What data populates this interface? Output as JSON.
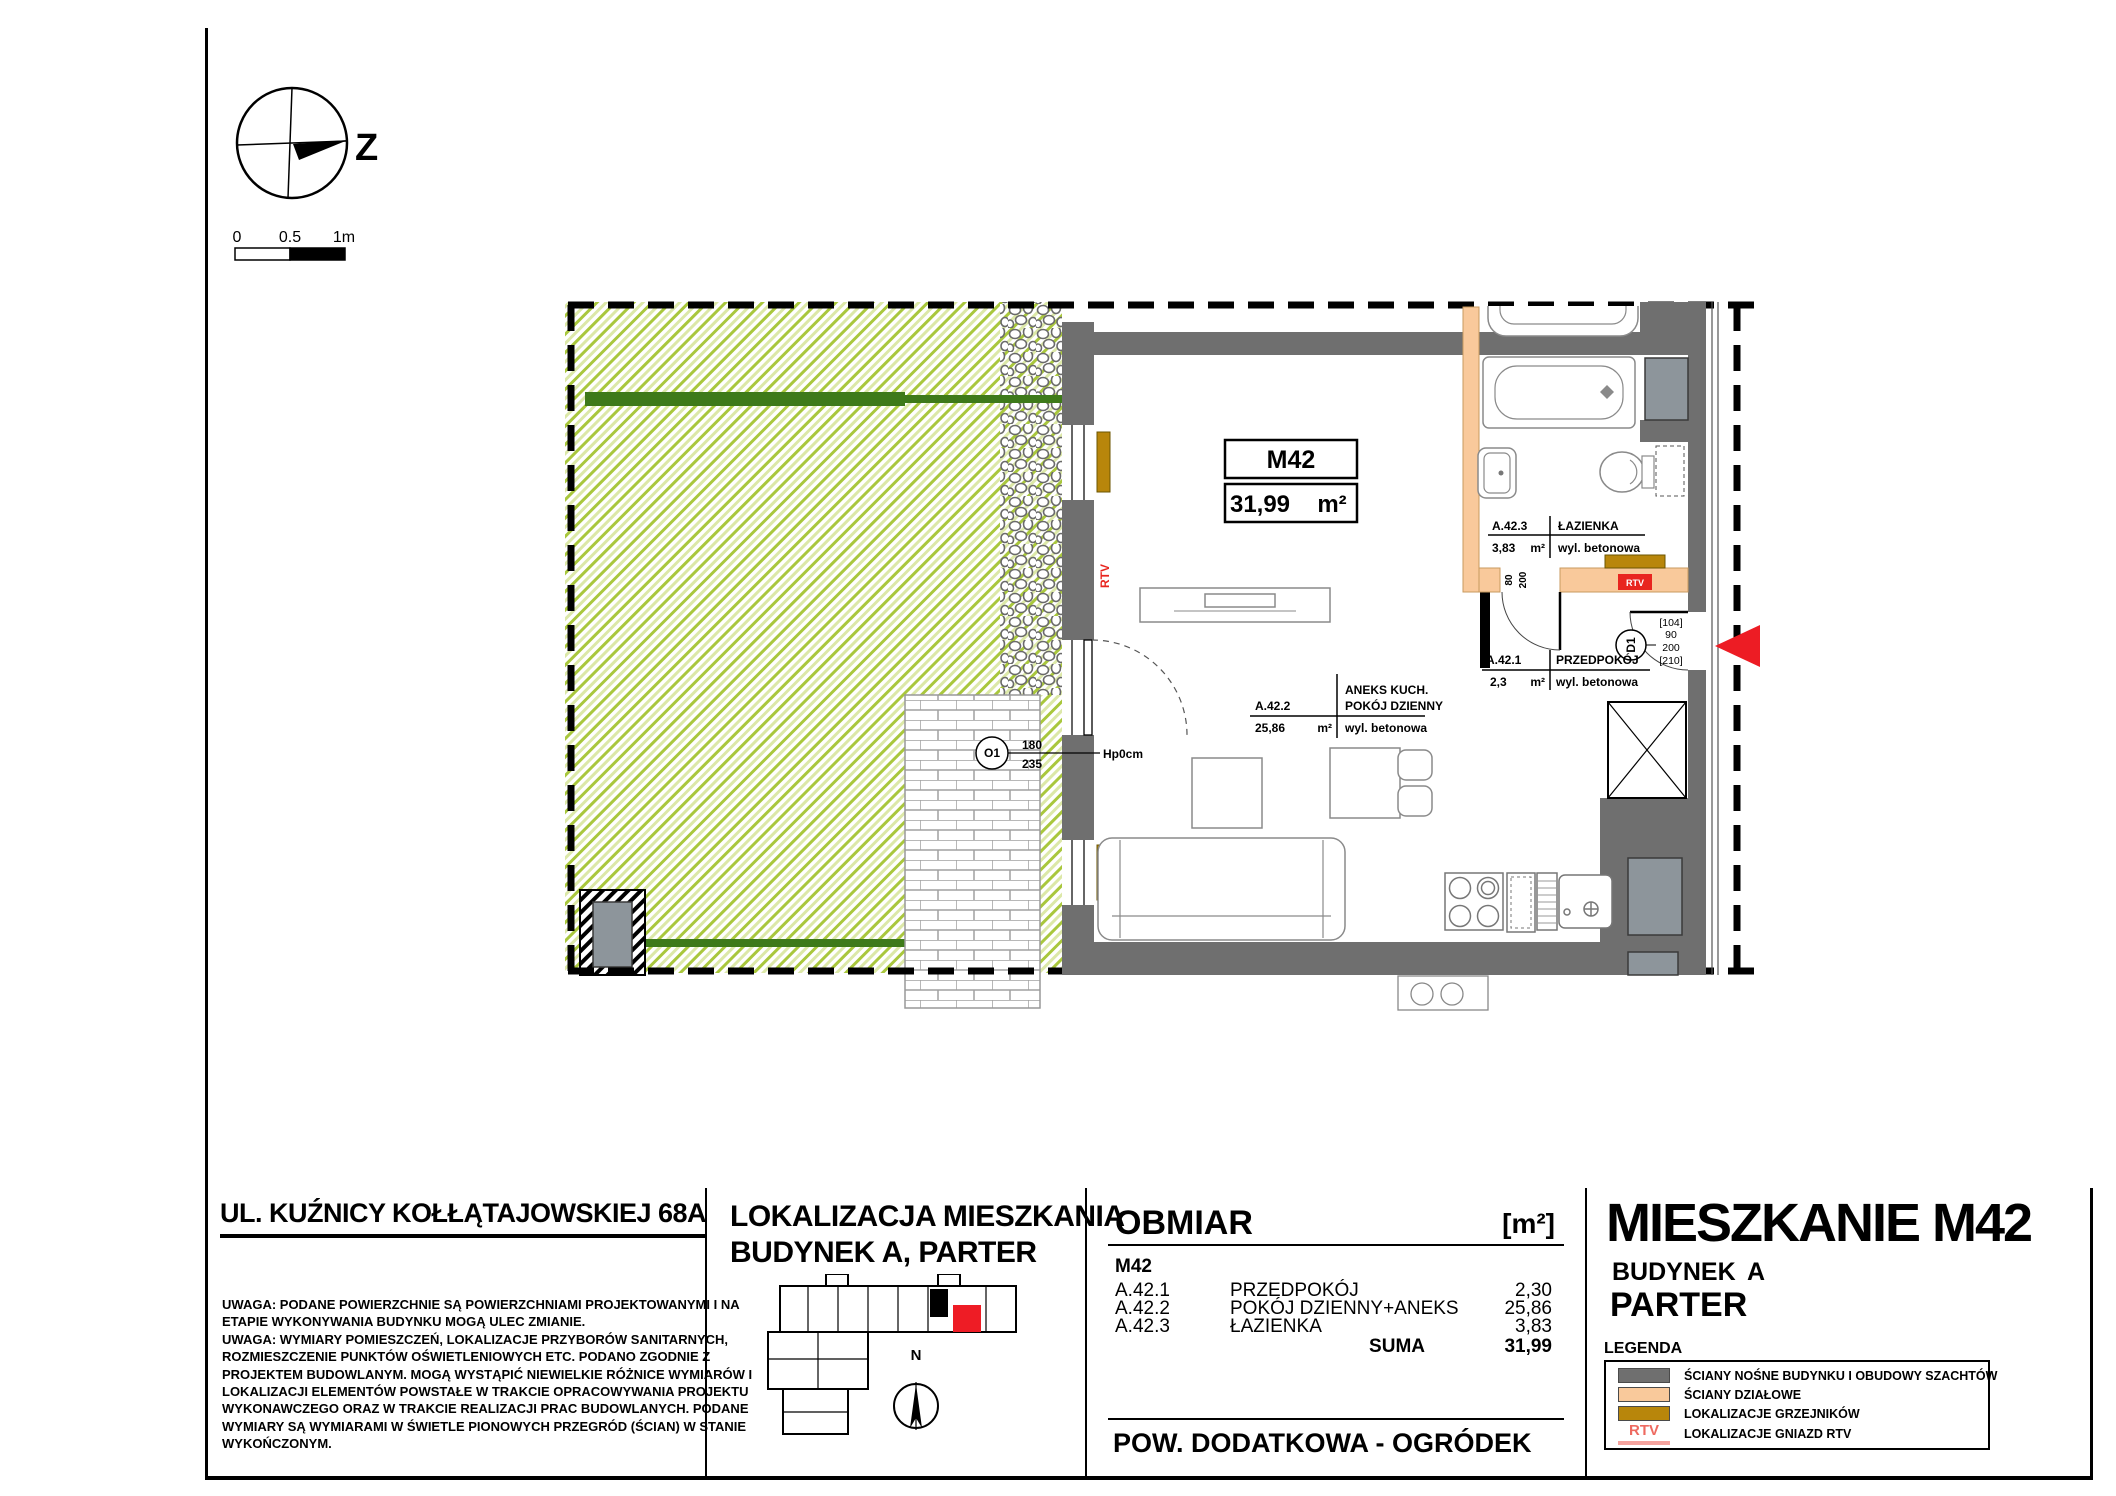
{
  "compass_main": {
    "label": "Z"
  },
  "compass_mini": {
    "label": "N"
  },
  "scale_bar": {
    "zero": "0",
    "half": "0.5",
    "one": "1m"
  },
  "plan": {
    "unit_code": "M42",
    "unit_area": "31,99",
    "unit_area_unit": "m²",
    "room_bath": {
      "code": "A.42.3",
      "name": "ŁAZIENKA",
      "area": "3,83",
      "unit": "m²",
      "finish": "wyl. betonowa"
    },
    "room_hall": {
      "code": "A.42.1",
      "name": "PRZEDPOKÓJ",
      "area": "2,3",
      "unit": "m²",
      "finish": "wyl. betonowa"
    },
    "room_living": {
      "code": "A.42.2",
      "name1": "ANEKS KUCH.",
      "name2": "POKÓJ DZIENNY",
      "area": "25,86",
      "unit": "m²",
      "finish": "wyl. betonowa"
    },
    "door_o1": {
      "code": "O1",
      "width": "180",
      "height": "235",
      "sill": "Hp0cm"
    },
    "door_d1": {
      "code": "D1",
      "dim1": "[104]",
      "dim2": "90",
      "dim3": "200",
      "dim4": "[210]"
    },
    "door_bath": {
      "width": "80",
      "height": "200"
    },
    "rtv_label": "RTV"
  },
  "address": {
    "title": "UL. KUŹNICY KOŁŁĄTAJOWSKIEJ 68A",
    "notes": [
      "UWAGA: PODANE POWIERZCHNIE SĄ POWIERZCHNIAMI PROJEKTOWANYMI I NA",
      "ETAPIE WYKONYWANIA BUDYNKU MOGĄ ULEC ZMIANIE.",
      "UWAGA: WYMIARY POMIESZCZEŃ, LOKALIZACJE PRZYBORÓW SANITARNYCH,",
      "ROZMIESZCZENIE PUNKTÓW OŚWIETLENIOWYCH ETC. PODANO ZGODNIE Z",
      "PROJEKTEM BUDOWLANYM. MOGĄ WYSTĄPIĆ NIEWIELKIE RÓŻNICE WYMIARÓW I",
      "LOKALIZACJI ELEMENTÓW POWSTAŁE W TRAKCIE OPRACOWYWANIA PROJEKTU",
      "WYKONAWCZEGO ORAZ W TRAKCIE REALIZACJI PRAC BUDOWLANYCH. PODANE",
      "WYMIARY SĄ WYMIARAMI W ŚWIETLE PIONOWYCH PRZEGRÓD (ŚCIAN) W STANIE",
      "WYKOŃCZONYM."
    ]
  },
  "location": {
    "line1": "LOKALIZACJA MIESZKANIA",
    "line2": "BUDYNEK A, PARTER"
  },
  "obmiar": {
    "title": "OBMIAR",
    "unit": "[m²]",
    "group": "M42",
    "rows": [
      {
        "code": "A.42.1",
        "name": "PRZEDPOKÓJ",
        "value": "2,30"
      },
      {
        "code": "A.42.2",
        "name": "POKÓJ DZIENNY+ANEKS",
        "value": "25,86"
      },
      {
        "code": "A.42.3",
        "name": "ŁAZIENKA",
        "value": "3,83"
      }
    ],
    "suma_label": "SUMA",
    "suma_value": "31,99",
    "additional": "POW. DODATKOWA - OGRÓDEK"
  },
  "title_block": {
    "title": "MIESZKANIE M42",
    "building_label": "BUDYNEK",
    "building_value": "A",
    "floor": "PARTER",
    "legend_title": "LEGENDA",
    "legend": [
      {
        "label": "ŚCIANY NOŚNE BUDYNKU I OBUDOWY SZACHTÓW",
        "color": "#6f6f6f"
      },
      {
        "label": "ŚCIANY DZIAŁOWE",
        "color": "#f9c99b"
      },
      {
        "label": "LOKALIZACJE GRZEJNIKÓW",
        "color": "#b8860b"
      },
      {
        "label": "LOKALIZACJE GNIAZD RTV",
        "color": "#ee6a60",
        "swatch_text": "RTV"
      }
    ]
  },
  "colors": {
    "wall": "#6f6f6f",
    "partition": "#f9c99b",
    "radiator": "#b8860b",
    "rtv_red": "#e8251f",
    "arrow_red": "#ed1c24",
    "shaft": "#8d959b",
    "hedge": "#3e7a1a",
    "garden_hatch": "#a9c73d",
    "unit_highlight": "#ee1c25"
  }
}
